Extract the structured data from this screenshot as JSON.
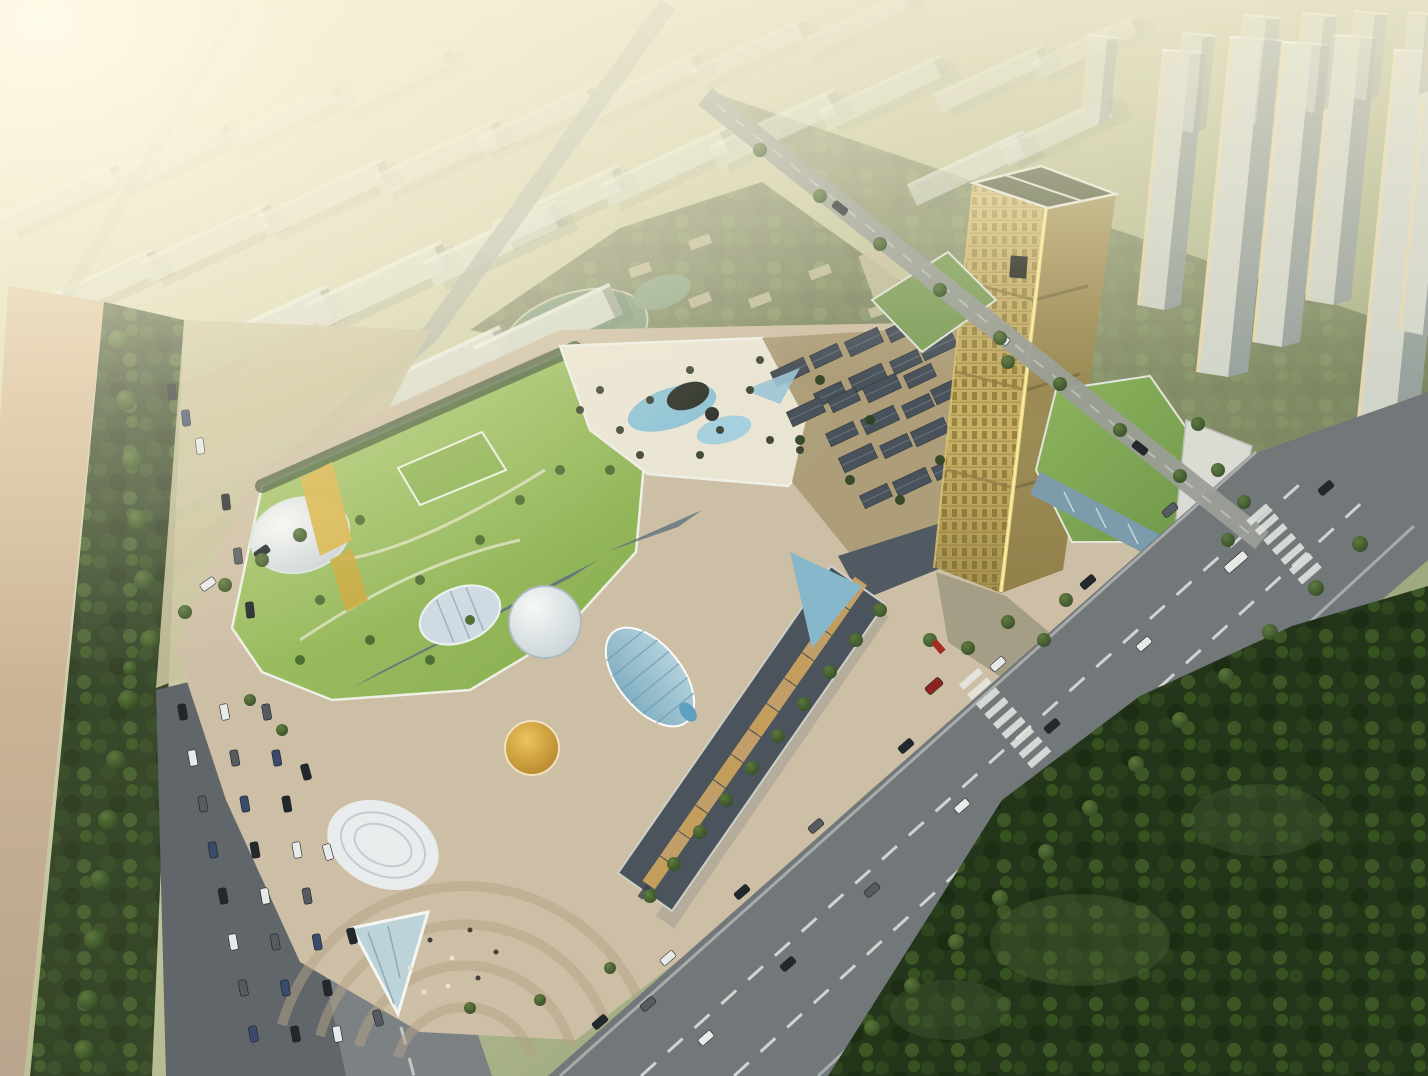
{
  "meta": {
    "type": "architectural-aerial-rendering",
    "description": "Sunset aerial rendering of a mixed-use development: a multi-block shopping mall with green roofs, white domes and blue glass canopies, a gold landmark office tower with podium, an old-town retail village, wide avenues with traffic, parking, a dark forest park at lower right, hazy rows of residential slabs upper-left and a cluster of high-rise towers upper-right.",
    "sun_glare_position": "top-left"
  },
  "palette": {
    "slab_face": "#dcded2",
    "slab_shadow": "#a7ac9d",
    "far_tower_face": "#d2d5ca",
    "far_tower_side": "#99a29d",
    "far_tower_glint": "#ead7a6",
    "pond": "#8aa183",
    "village_base": "#ab9b76",
    "village_roof": "#49525a",
    "site_ground": "#cdbfa5",
    "lawn_path": "#dde2bf",
    "deck": "#eae4d3",
    "pool": "#90c4d6",
    "deck_dark": "#2f342c",
    "leaf_rib": "#6e9cb0",
    "atrium_blue": "#86b7cb",
    "spine_glass": "#5e7280",
    "gold_face": "#c8b26a",
    "gold_seam": "#ead87e",
    "tower_cap": "#6a7053",
    "podium_glass": "#7d9cab",
    "podium_white": "#dadbd2",
    "office_green": "#7f9f5b",
    "avenue": "#72777a",
    "road_line": "#e8ebe6",
    "left_road": "#7c8183",
    "ne_street": "#9a9e96",
    "nw_street": "#a8ada3",
    "sidewalk": "#b3ab9c",
    "parking": "#61666a",
    "plaza_arc": "#b5a288",
    "forest_hi": "#51683a",
    "tree": "#3c5a2c",
    "canopy_glass": "#bcd3da",
    "shop_tan": "#c8a368",
    "shop_gold": "#caa25c",
    "wing_dark": "#4b545c",
    "car_dark": "#23282d",
    "car_white": "#e8eaea",
    "car_gray": "#555b60",
    "car_blue": "#3a4a6b",
    "car_red": "#8e2420",
    "red_accent": "#a32b22",
    "field": "#c9c29e"
  },
  "scene": {
    "slab_buildings": [
      [
        205,
        475,
        165,
        40
      ],
      [
        320,
        425,
        160,
        38
      ],
      [
        435,
        375,
        158,
        36
      ],
      [
        548,
        330,
        150,
        34
      ],
      [
        150,
        380,
        150,
        32
      ],
      [
        265,
        330,
        150,
        31
      ],
      [
        380,
        285,
        148,
        30
      ],
      [
        495,
        243,
        146,
        28
      ],
      [
        95,
        288,
        140,
        26
      ],
      [
        210,
        242,
        140,
        25
      ],
      [
        325,
        197,
        138,
        24
      ],
      [
        440,
        157,
        136,
        23
      ],
      [
        62,
        198,
        128,
        21
      ],
      [
        172,
        157,
        128,
        20
      ],
      [
        285,
        117,
        126,
        19
      ],
      [
        396,
        80,
        124,
        18
      ],
      [
        560,
        205,
        140,
        26
      ],
      [
        668,
        166,
        140,
        25
      ],
      [
        776,
        128,
        138,
        24
      ],
      [
        884,
        92,
        134,
        22
      ],
      [
        538,
        120,
        130,
        21
      ],
      [
        644,
        86,
        128,
        20
      ],
      [
        750,
        52,
        126,
        19
      ],
      [
        856,
        24,
        124,
        18
      ],
      [
        970,
        168,
        128,
        24
      ],
      [
        1060,
        130,
        124,
        22
      ],
      [
        992,
        78,
        120,
        20
      ],
      [
        1088,
        46,
        118,
        19
      ]
    ],
    "midrise_blocks": [
      [
        640,
        270,
        22,
        10
      ],
      [
        700,
        242,
        22,
        10
      ],
      [
        760,
        300,
        22,
        10
      ],
      [
        820,
        272,
        22,
        10
      ],
      [
        880,
        310,
        22,
        10
      ],
      [
        700,
        300,
        22,
        10
      ],
      [
        880,
        272,
        30,
        44
      ]
    ],
    "far_towers": [
      [
        1137,
        305,
        44,
        255
      ],
      [
        1196,
        372,
        52,
        335
      ],
      [
        1252,
        342,
        48,
        300
      ],
      [
        1305,
        300,
        46,
        265
      ],
      [
        1352,
        468,
        62,
        418
      ],
      [
        1398,
        330,
        40,
        300
      ],
      [
        1172,
        128,
        34,
        95
      ],
      [
        1232,
        120,
        38,
        105
      ],
      [
        1292,
        108,
        36,
        95
      ],
      [
        1345,
        96,
        34,
        85
      ],
      [
        1400,
        90,
        30,
        78
      ],
      [
        1080,
        120,
        30,
        85
      ]
    ],
    "oldtown_roofs": [
      [
        790,
        372
      ],
      [
        826,
        356
      ],
      [
        864,
        342
      ],
      [
        902,
        330
      ],
      [
        938,
        346
      ],
      [
        906,
        362
      ],
      [
        868,
        378
      ],
      [
        830,
        394
      ],
      [
        806,
        412
      ],
      [
        844,
        400
      ],
      [
        882,
        388
      ],
      [
        920,
        376
      ],
      [
        950,
        390
      ],
      [
        918,
        406
      ],
      [
        880,
        420
      ],
      [
        842,
        434
      ],
      [
        858,
        458
      ],
      [
        896,
        446
      ],
      [
        930,
        432
      ],
      [
        948,
        468
      ],
      [
        912,
        482
      ],
      [
        876,
        496
      ]
    ],
    "frontage": {
      "x0": 858,
      "y0": 585,
      "ux": -0.572,
      "uy": 0.82,
      "step": 31,
      "count": 12,
      "w": 30,
      "h": 15,
      "angle": -55
    },
    "cars": {
      "avenue": [
        [
          600,
          1022,
          "d"
        ],
        [
          668,
          958,
          "w"
        ],
        [
          742,
          892,
          "d"
        ],
        [
          816,
          826,
          "g"
        ],
        [
          906,
          746,
          "d"
        ],
        [
          998,
          664,
          "w"
        ],
        [
          1088,
          582,
          "d"
        ],
        [
          1170,
          510,
          "g"
        ],
        [
          706,
          1038,
          "w"
        ],
        [
          788,
          964,
          "d"
        ],
        [
          872,
          890,
          "g"
        ],
        [
          962,
          806,
          "w"
        ],
        [
          1052,
          726,
          "d"
        ],
        [
          1144,
          644,
          "w"
        ],
        [
          1236,
          562,
          "bus"
        ],
        [
          1326,
          488,
          "d"
        ],
        [
          648,
          1004,
          "g"
        ],
        [
          934,
          686,
          "r"
        ]
      ],
      "left_road": [
        [
          306,
          772,
          "d"
        ],
        [
          328,
          852,
          "w"
        ],
        [
          352,
          936,
          "d"
        ],
        [
          378,
          1018,
          "g"
        ]
      ],
      "nw_street": [
        [
          208,
          584,
          "w"
        ],
        [
          262,
          552,
          "d"
        ]
      ],
      "ne_street": [
        [
          840,
          208,
          "d"
        ],
        [
          1002,
          338,
          "w"
        ],
        [
          1140,
          448,
          "d"
        ]
      ],
      "field_parked": [
        [
          172,
          392,
          "d"
        ],
        [
          186,
          418,
          "b"
        ],
        [
          200,
          446,
          "w"
        ],
        [
          226,
          502,
          "d"
        ],
        [
          238,
          556,
          "g"
        ],
        [
          250,
          610,
          "d"
        ]
      ]
    },
    "parking_rows": {
      "cols": [
        180,
        222,
        264
      ],
      "y0": 712,
      "step": 46,
      "n": 8,
      "drift": 0.22
    },
    "crosswalks": [
      [
        1005,
        718,
        9
      ],
      [
        1284,
        544,
        7
      ]
    ],
    "trees": {
      "verge": {
        "r": 8,
        "pts": [
          [
            872,
            1028
          ],
          [
            912,
            986
          ],
          [
            956,
            942
          ],
          [
            1000,
            898
          ],
          [
            1046,
            852
          ],
          [
            1090,
            808
          ],
          [
            1136,
            764
          ],
          [
            1180,
            720
          ],
          [
            1226,
            676
          ],
          [
            1270,
            632
          ],
          [
            1316,
            588
          ],
          [
            1360,
            544
          ]
        ]
      },
      "frontage": {
        "r": 7,
        "pts": [
          [
            880,
            610
          ],
          [
            856,
            640
          ],
          [
            830,
            672
          ],
          [
            804,
            704
          ],
          [
            778,
            736
          ],
          [
            752,
            768
          ],
          [
            726,
            800
          ],
          [
            700,
            832
          ],
          [
            674,
            864
          ],
          [
            650,
            896
          ]
        ]
      },
      "plaza": {
        "r": 7,
        "pts": [
          [
            1008,
            622
          ],
          [
            1044,
            640
          ],
          [
            968,
            648
          ],
          [
            1066,
            600
          ],
          [
            930,
            640
          ]
        ]
      },
      "podium": {
        "r": 7,
        "pts": [
          [
            1218,
            470
          ],
          [
            1244,
            502
          ],
          [
            1228,
            540
          ],
          [
            1198,
            424
          ],
          [
            1008,
            362
          ]
        ]
      },
      "ne_side": {
        "r": 7,
        "pts": [
          [
            760,
            150
          ],
          [
            820,
            196
          ],
          [
            880,
            244
          ],
          [
            940,
            290
          ],
          [
            1000,
            338
          ],
          [
            1060,
            384
          ],
          [
            1120,
            430
          ],
          [
            1180,
            476
          ]
        ]
      },
      "nw_side": {
        "r": 7,
        "pts": [
          [
            150,
            640
          ],
          [
            185,
            612
          ],
          [
            225,
            585
          ],
          [
            262,
            560
          ],
          [
            300,
            535
          ],
          [
            130,
            668
          ]
        ]
      },
      "boulevard": {
        "r": 10,
        "pts": [
          [
            118,
            340
          ],
          [
            126,
            400
          ],
          [
            132,
            460
          ],
          [
            138,
            520
          ],
          [
            144,
            580
          ],
          [
            150,
            640
          ],
          [
            128,
            700
          ],
          [
            116,
            760
          ],
          [
            108,
            820
          ],
          [
            100,
            880
          ],
          [
            94,
            940
          ],
          [
            88,
            1000
          ],
          [
            84,
            1050
          ]
        ]
      },
      "site_misc": {
        "r": 6,
        "pts": [
          [
            250,
            700
          ],
          [
            282,
            730
          ],
          [
            470,
            1008
          ],
          [
            540,
            1000
          ],
          [
            610,
            968
          ]
        ]
      },
      "lawn": {
        "r": 5,
        "c": "#4a6b31",
        "pts": [
          [
            320,
            600
          ],
          [
            370,
            640
          ],
          [
            420,
            580
          ],
          [
            480,
            540
          ],
          [
            360,
            520
          ],
          [
            300,
            660
          ],
          [
            520,
            500
          ],
          [
            560,
            470
          ],
          [
            610,
            470
          ],
          [
            470,
            620
          ],
          [
            430,
            660
          ]
        ]
      },
      "deck": {
        "r": 4,
        "c": "#39402f",
        "pts": [
          [
            600,
            390
          ],
          [
            620,
            430
          ],
          [
            650,
            400
          ],
          [
            690,
            370
          ],
          [
            720,
            430
          ],
          [
            750,
            390
          ],
          [
            770,
            440
          ],
          [
            640,
            455
          ],
          [
            700,
            455
          ],
          [
            580,
            410
          ],
          [
            760,
            360
          ],
          [
            800,
            450
          ]
        ]
      },
      "oldtown": {
        "r": 5,
        "c": "#2f4425",
        "pts": [
          [
            800,
            440
          ],
          [
            850,
            480
          ],
          [
            900,
            500
          ],
          [
            940,
            460
          ],
          [
            870,
            420
          ],
          [
            820,
            380
          ]
        ]
      }
    },
    "people": [
      [
        430,
        940
      ],
      [
        452,
        958
      ],
      [
        470,
        930
      ],
      [
        410,
        968
      ],
      [
        496,
        952
      ],
      [
        448,
        986
      ],
      [
        478,
        978
      ],
      [
        424,
        992
      ]
    ]
  }
}
